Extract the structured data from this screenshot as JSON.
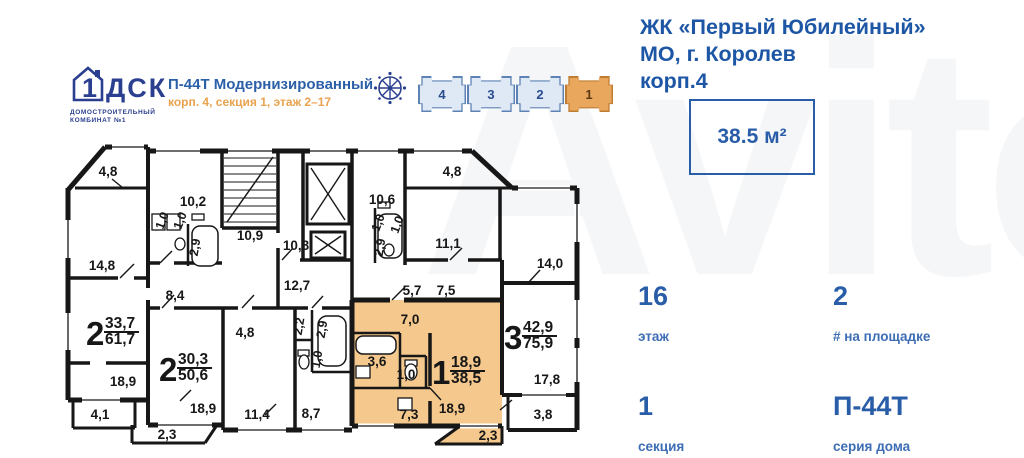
{
  "header": {
    "logo": {
      "house_char": "1",
      "brand": "ДСК",
      "caption1": "ДОМОСТРОИТЕЛЬНЫЙ",
      "caption2": "КОМБИНАТ №1"
    },
    "title": "П-44Т Модернизированный",
    "subtitle": "корп. 4, секция 1, этаж 2–17"
  },
  "building_selector": {
    "sections": [
      {
        "label": "4",
        "active": false
      },
      {
        "label": "3",
        "active": false
      },
      {
        "label": "2",
        "active": false
      },
      {
        "label": "1",
        "active": true
      }
    ]
  },
  "info_panel": {
    "title_lines": [
      "ЖК «Первый Юбилейный»",
      "МО, г. Королев",
      "корп.4"
    ],
    "area": "38.5 м²",
    "stats": [
      {
        "value": "16",
        "label": "этаж"
      },
      {
        "value": "2",
        "label": "# на площадке"
      },
      {
        "value": "1",
        "label": "секция"
      },
      {
        "value": "П-44Т",
        "label": "серия дома"
      }
    ]
  },
  "watermark": "Avito",
  "colors": {
    "accent_blue": "#2a5da8",
    "accent_orange": "#e9a24e",
    "highlight_fill": "#f5c88d",
    "plan_line": "#171717"
  },
  "floorplan": {
    "labels": [
      {
        "t": "4,8",
        "x": 48,
        "y": 38
      },
      {
        "t": "10,2",
        "x": 133,
        "y": 68
      },
      {
        "t": "1,0",
        "x": 106,
        "y": 84,
        "r": -70
      },
      {
        "t": "1,0",
        "x": 124,
        "y": 84,
        "r": -70
      },
      {
        "t": "2,9",
        "x": 139,
        "y": 110,
        "r": -80
      },
      {
        "t": "10,9",
        "x": 190,
        "y": 102
      },
      {
        "t": "14,8",
        "x": 42,
        "y": 132
      },
      {
        "t": "8,4",
        "x": 115,
        "y": 162
      },
      {
        "t": "10,8",
        "x": 236,
        "y": 112
      },
      {
        "t": "12,7",
        "x": 237,
        "y": 152
      },
      {
        "t": "10,6",
        "x": 322,
        "y": 66
      },
      {
        "t": "1,0",
        "x": 322,
        "y": 86,
        "r": -70
      },
      {
        "t": "1,0",
        "x": 341,
        "y": 88,
        "r": -70
      },
      {
        "t": "2,9",
        "x": 324,
        "y": 110,
        "r": -80
      },
      {
        "t": "11,1",
        "x": 388,
        "y": 110
      },
      {
        "t": "4,8",
        "x": 392,
        "y": 38
      },
      {
        "t": "14,0",
        "x": 490,
        "y": 130
      },
      {
        "t": "5,7",
        "x": 352,
        "y": 157
      },
      {
        "t": "7,5",
        "x": 386,
        "y": 157
      },
      {
        "t": "4,8",
        "x": 185,
        "y": 199
      },
      {
        "t": "2,2",
        "x": 243,
        "y": 189,
        "r": -80
      },
      {
        "t": "2,9",
        "x": 266,
        "y": 192,
        "r": -80
      },
      {
        "t": "1,0",
        "x": 261,
        "y": 222,
        "r": -80
      },
      {
        "t": "7,0",
        "x": 350,
        "y": 186
      },
      {
        "t": "3,6",
        "x": 317,
        "y": 228
      },
      {
        "t": "1,0",
        "x": 346,
        "y": 241
      },
      {
        "t": "7,3",
        "x": 349,
        "y": 281
      },
      {
        "t": "18,9",
        "x": 392,
        "y": 275
      },
      {
        "t": "18,9",
        "x": 63,
        "y": 248
      },
      {
        "t": "4,1",
        "x": 40,
        "y": 281
      },
      {
        "t": "18,9",
        "x": 143,
        "y": 275
      },
      {
        "t": "2,3",
        "x": 107,
        "y": 301
      },
      {
        "t": "11,4",
        "x": 197,
        "y": 281
      },
      {
        "t": "8,7",
        "x": 251,
        "y": 280
      },
      {
        "t": "2,3",
        "x": 428,
        "y": 302
      },
      {
        "t": "17,8",
        "x": 487,
        "y": 246
      },
      {
        "t": "3,8",
        "x": 483,
        "y": 281
      }
    ],
    "apartments": [
      {
        "n": "2",
        "top": "33,7",
        "bot": "61,7",
        "x": 26,
        "y": 207
      },
      {
        "n": "2",
        "top": "30,3",
        "bot": "50,6",
        "x": 99,
        "y": 243
      },
      {
        "n": "1",
        "top": "18,9",
        "bot": "38,5",
        "x": 372,
        "y": 246
      },
      {
        "n": "3",
        "top": "42,9",
        "bot": "75,9",
        "x": 444,
        "y": 211
      }
    ]
  }
}
